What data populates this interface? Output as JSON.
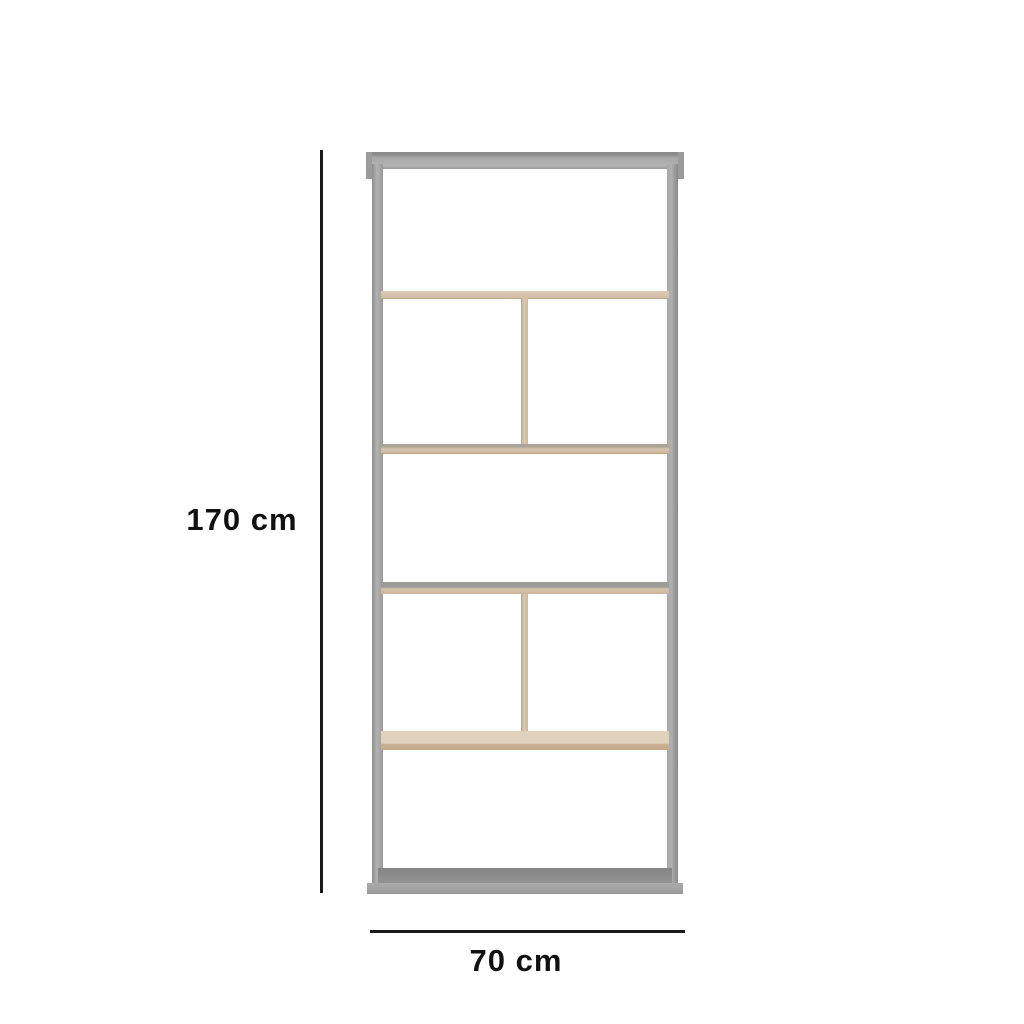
{
  "page": {
    "type": "product-dimension-diagram",
    "background_color": "#ffffff"
  },
  "annotations": {
    "height_label": "170 cm",
    "width_label": "70 cm",
    "line_color": "#1a1a1a",
    "text_color": "#111111"
  },
  "furniture": {
    "name": "open shelving unit / bookcase",
    "tier_count": 5,
    "parts": [
      "top-panel",
      "left-post",
      "right-post",
      "shelf-1",
      "divider-1",
      "shelf-2",
      "shelf-3",
      "divider-2",
      "shelf-4",
      "base-panel"
    ],
    "colors": {
      "frame_gray": "#a2a2a2",
      "frame_gray_dark": "#8a8a8a",
      "frame_gray_light": "#b3b3b3",
      "wood_light": "#d6c3ac",
      "wood_pale_top": "#e0d1bc",
      "wood_edge_dark": "#bca78c"
    }
  }
}
